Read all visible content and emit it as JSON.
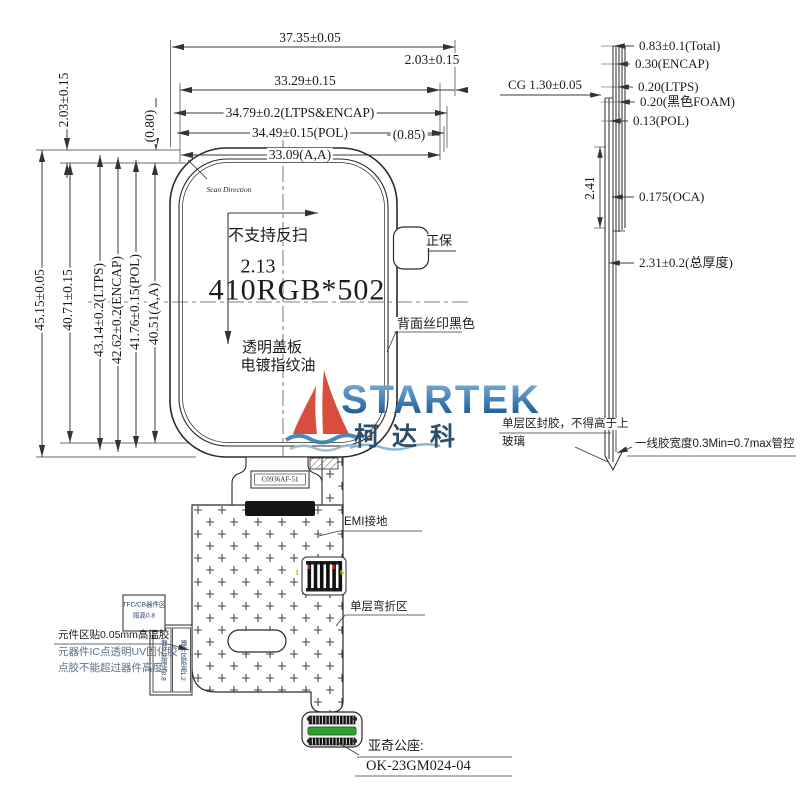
{
  "front": {
    "dim_total_w": "37.35±0.05",
    "dim_cg_w": "33.29±0.15",
    "dim_right_gap": "2.03±0.15",
    "dim_ltps_encap_w": "34.79±0.2(LTPS&ENCAP)",
    "dim_pol_w": "34.49±0.15(POL)",
    "dim_aa_w": "33.09(A,A)",
    "dim_085": "(0.85)",
    "dim_080": "(0.80)",
    "dim_top_gap": "2.03±0.15",
    "dim_total_h": "45.15±0.05",
    "dim_h2": "40.71±0.15",
    "dim_ltps_h": "43.14±0.2(LTPS)",
    "dim_encap_h": "42.62±0.2(ENCAP)",
    "dim_pol_h": "41.76±0.15(POL)",
    "dim_aa_h": "40.51(A,A)",
    "scan_direction": "Scan Direction",
    "no_reverse": "不支持反扫",
    "value_213": "2.13",
    "resolution": "410RGB*502",
    "cover1": "透明盖板",
    "cover2": "电镀指纹油",
    "front_side": "正保",
    "back_print": "背面丝印黑色"
  },
  "section": {
    "cg": "CG 1.30±0.05",
    "total": "0.83±0.1(Total)",
    "encap": "0.30(ENCAP)",
    "ltps": "0.20(LTPS)",
    "foam": "0.20(黑色FOAM)",
    "pol": "0.13(POL)",
    "oca": "0.175(OCA)",
    "thickness": "2.31±0.2(总厚度)",
    "gap_241": "2.41",
    "glue1": "单层区封胶，不得高于上",
    "glue2": "玻璃",
    "line_glue": "一线胶宽度0.3Min=0.7max管控"
  },
  "fpc": {
    "ic_label": "C0936AF-51",
    "emi": "EMI接地",
    "bend_zone": "单层弯折区",
    "pin_first": "1",
    "pin_last": "6",
    "comp_box1_line1": "TFC/CB器件区",
    "comp_box1_line2": "限高0.8",
    "comp_box2": "器件区限高0.8",
    "comp_box3": "器件区限高1.2",
    "note1": "元件区贴0.05mm高温胶",
    "note2": "元器件IC点透明UV固化胶",
    "note3": "点胶不能超过器件高度",
    "connector_name": "亚奇公座:",
    "connector_pn": "OK-23GM024-04"
  },
  "logo": {
    "brand": "STARTEK",
    "cn": "柯达科"
  },
  "colors": {
    "line": "#3a3a3a",
    "sail_red": "#d6402e",
    "wave_blue": "#3f7fb5",
    "connector_green": "#31a031",
    "pin_yellow": "#cfc000"
  }
}
